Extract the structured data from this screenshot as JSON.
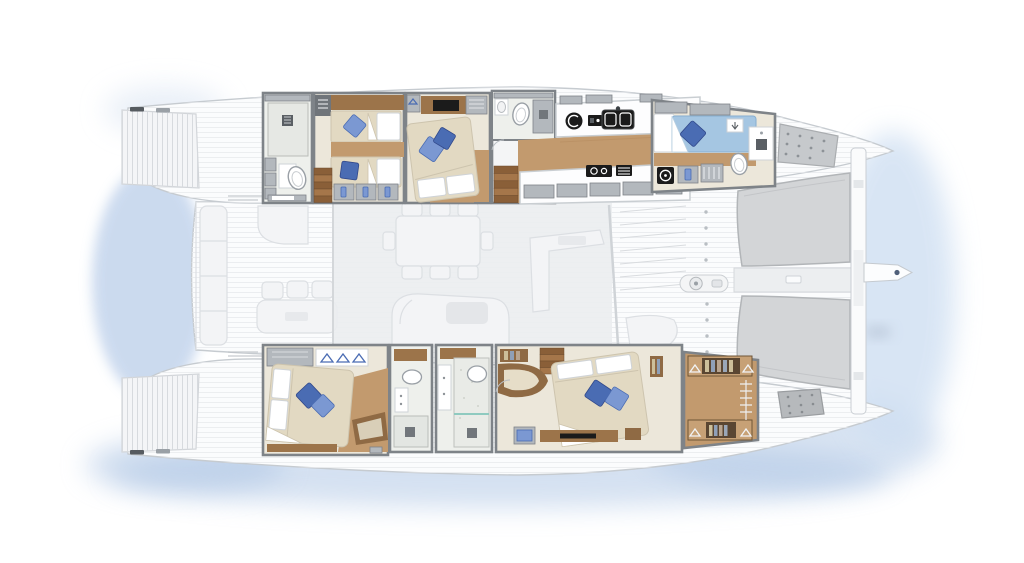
{
  "title": "Sailing catamaran — top-down deck and accommodation floor plan",
  "legend": {
    "view": "Top view deck plan with ghosted main-deck furniture",
    "vessel_type": "Cruising sailing catamaran"
  },
  "layout": {
    "port_hull": {
      "name": "Port hull (top)",
      "rooms": [
        {
          "id": "aft-head",
          "name": "Aft bathroom with shower, vanity and toilet"
        },
        {
          "id": "twin-cabin",
          "name": "Twin guest cabin with two single berths and gear lockers"
        },
        {
          "id": "vip-cabin",
          "name": "Double guest cabin with TV cabinet and wardrobe"
        },
        {
          "id": "mid-head",
          "name": "Guest bathroom with shower and toilet"
        },
        {
          "id": "galley",
          "name": "Galley with double sink, cooktop, oven and extractor"
        },
        {
          "id": "fore-cabin",
          "name": "Forward cabin with single berth, washer, toilet and shower"
        },
        {
          "id": "bow-locker",
          "name": "Bow deck locker panel"
        }
      ]
    },
    "starboard_hull": {
      "name": "Starboard hull (bottom)",
      "rooms": [
        {
          "id": "aft-cabin",
          "name": "Aft double cabin with hanging wardrobe and window seat"
        },
        {
          "id": "shower-room",
          "name": "Shower room with basin and vanity"
        },
        {
          "id": "master-bath",
          "name": "Master bathroom with walk-in marble shower"
        },
        {
          "id": "master-cabin",
          "name": "Master double cabin with lounge seat, desk and bookshelves"
        },
        {
          "id": "walk-in-wardrobe",
          "name": "Walk-in wardrobe with hanger rail and shelves"
        },
        {
          "id": "bow-hatch",
          "name": "Bow deck hatch"
        }
      ]
    },
    "bridgedeck": {
      "name": "Bridgedeck",
      "areas": [
        {
          "id": "aft-cockpit",
          "name": "Aft cockpit with bench seating, dining chairs and lounge"
        },
        {
          "id": "saloon",
          "name": "Saloon with dining table for eight and curved sofa"
        },
        {
          "id": "fore-cockpit",
          "name": "Forward cockpit walkway"
        },
        {
          "id": "foredeck",
          "name": "Foredeck with anchor windlass and deck hardware"
        },
        {
          "id": "trampolines",
          "name": "Twin bow trampolines"
        },
        {
          "id": "crossbeam",
          "name": "Forward crossbeam"
        },
        {
          "id": "bowsprit",
          "name": "Bowsprit"
        }
      ]
    },
    "stern": {
      "areas": [
        {
          "id": "swim-platforms",
          "name": "Twin transom swim platforms with moulded steps"
        }
      ]
    }
  },
  "counts": {
    "cabins": 5,
    "bathrooms": 5,
    "double_berths": 3,
    "single_berths": 3,
    "dining_seats": 8,
    "trampolines": 2
  },
  "colors": {
    "hull_white": "#fbfcfd",
    "deck_line": "#e7eaec",
    "outline": "#c6cbd0",
    "ghost_fill": "#f3f4f6",
    "ghost_stroke": "#dcdfe3",
    "saloon_shade": "#ebedef",
    "wall_dark": "#7e8388",
    "wall_mid": "#b3b8bd",
    "floor_cream": "#ece7da",
    "bed_cream": "#e2d9c2",
    "wood": "#c29a6e",
    "wood_dark": "#9c744a",
    "wood_shelf": "#8f6a44",
    "pillow_blue": "#4a6cb3",
    "pillow_blue_light": "#7b98d2",
    "mattress_blue": "#a5c6e2",
    "marble": "#eef0ec",
    "appliance_black": "#1b1b1b",
    "tramp_gray": "#d3d5d7",
    "water_blue": "#aac3e3",
    "water_blue_light": "#cfdff2",
    "hatch_gray": "#b6b9bc"
  }
}
